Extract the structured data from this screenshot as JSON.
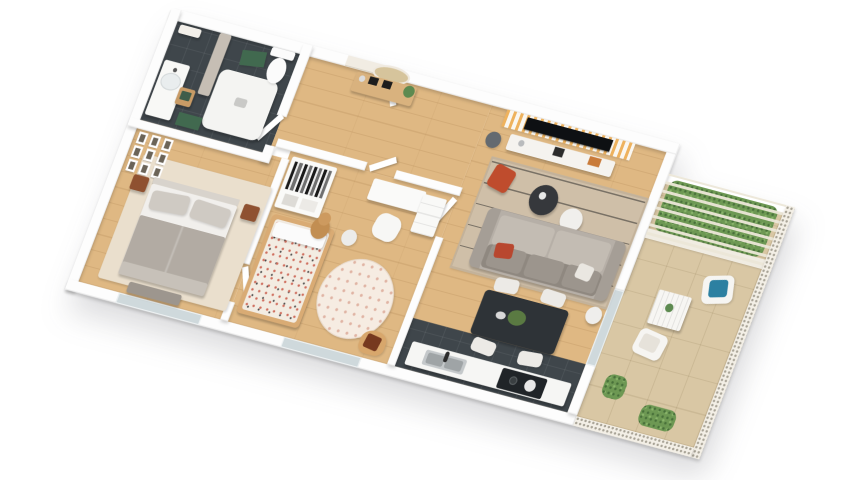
{
  "scene": {
    "type": "isometric-3d-floor-plan-render",
    "background": "#ffffff",
    "description_labels": {
      "apartment": "one-bedroom-plus-kids-room apartment with terrace"
    }
  },
  "palette": {
    "wood_floor": "#dfb883",
    "dark_tile_floor": "#3f464b",
    "terrace_tile": "#d9c7a4",
    "wall_white": "#fdfdfd",
    "rug_beige": "#cfbfa8",
    "sofa_gray": "#b6afa7",
    "stripe_wall_orange": "#eeb25e",
    "accent_red_ottoman": "#bf4c2d",
    "teal_cushion": "#2C80A1",
    "hedge_green": "#6d9853",
    "bath_mat_green": "#41694f",
    "wood_furniture": "#d9ab74",
    "dining_table_charcoal": "#2e3337",
    "tv_black": "#0e1013",
    "glass": "#cfd9dc"
  },
  "rooms": {
    "bathroom": {
      "label": "bathroom",
      "floor": "#3f464b",
      "items": [
        "vanity with sink",
        "shower tray",
        "toilet",
        "marble partition",
        "green bath mats",
        "wooden stool with towels",
        "shelf"
      ]
    },
    "entry_hall": {
      "label": "entry hall",
      "floor": "#dfb883",
      "items": [
        "entrance door",
        "console table",
        "oval wall mirror",
        "plant",
        "picture frames"
      ]
    },
    "master_bedroom": {
      "label": "master bedroom",
      "floor": "#dfb883",
      "items": [
        "double bed",
        "gallery wall frames",
        "nightstands",
        "bench",
        "area rug",
        "window"
      ]
    },
    "kids_bedroom": {
      "label": "kids bedroom",
      "floor": "#dfb883",
      "items": [
        "open wardrobe",
        "kids bed",
        "teddy bear",
        "round rug",
        "desk",
        "chair",
        "dresser",
        "rattan chair",
        "window"
      ]
    },
    "living_room": {
      "label": "living room",
      "floor": "#dfb883",
      "items": [
        "striped accent wall",
        "wall tv",
        "media console",
        "floor lamp",
        "striped rug",
        "red ottoman",
        "coffee tables",
        "sofa",
        "side table"
      ]
    },
    "dining_area": {
      "label": "dining area",
      "floor": "#dfb883",
      "items": [
        "dining table",
        "four chairs",
        "plant centerpiece"
      ]
    },
    "kitchen": {
      "label": "kitchen",
      "floor": "#3f464b",
      "items": [
        "counter",
        "sink",
        "faucet",
        "cooktop",
        "pots"
      ]
    },
    "terrace": {
      "label": "terrace",
      "floor": "#d9c7a4",
      "items": [
        "pergola slats",
        "hedge planter",
        "outdoor table",
        "outdoor chairs",
        "teal cushion",
        "olive plant",
        "shrub",
        "perforated railing"
      ]
    }
  },
  "furniture": {
    "vanity": "bathroom vanity with sink",
    "shower": "walk-in shower tray",
    "toilet": "toilet",
    "marble_partition": "marble shower partition",
    "bath_mat": "green bath mat",
    "stool": "wooden stool with towels",
    "console_table": "entry console table",
    "mirror": "oval wall mirror",
    "entrance_door": "apartment entrance door",
    "double_bed": "double bed with gray bedding",
    "gallery_wall": "gallery wall of framed pictures",
    "nightstand": "wooden nightstand",
    "bench": "bedroom bench",
    "bedroom_rug": "bedroom area rug",
    "window": "window",
    "wardrobe": "open wardrobe with hanging clothes",
    "kids_bed": "kids bed with patterned quilt",
    "teddy_bear": "teddy bear",
    "round_rug": "round patterned rug",
    "desk": "white desk",
    "desk_chair": "desk chair",
    "dresser": "white dresser",
    "rattan_chair": "rattan chair with brown cushion",
    "tv_wall": "orange striped tv wall",
    "tv": "wall-mounted tv",
    "media_console": "white media console",
    "floor_lamp": "floor lamp",
    "living_rug": "beige striped rug",
    "ottoman": "red ottoman",
    "coffee_table_dark": "dark round coffee table",
    "coffee_table_white": "white round coffee table",
    "tray_table": "woven tray table",
    "sofa": "gray three-seat sofa",
    "side_table": "round side table",
    "dining_table": "charcoal dining table",
    "dining_chair": "upholstered dining chair",
    "kitchen_counter": "kitchen counter",
    "sink": "stainless sink",
    "cooktop": "dark cooktop",
    "sliding_door": "glazed terrace door",
    "pergola": "pergola with slats",
    "hedge": "hedge planter",
    "outdoor_table": "outdoor slatted table",
    "outdoor_chair": "outdoor chair",
    "olive_plant": "olive plant",
    "shrub": "green shrub",
    "railing": "perforated terrace railing"
  }
}
